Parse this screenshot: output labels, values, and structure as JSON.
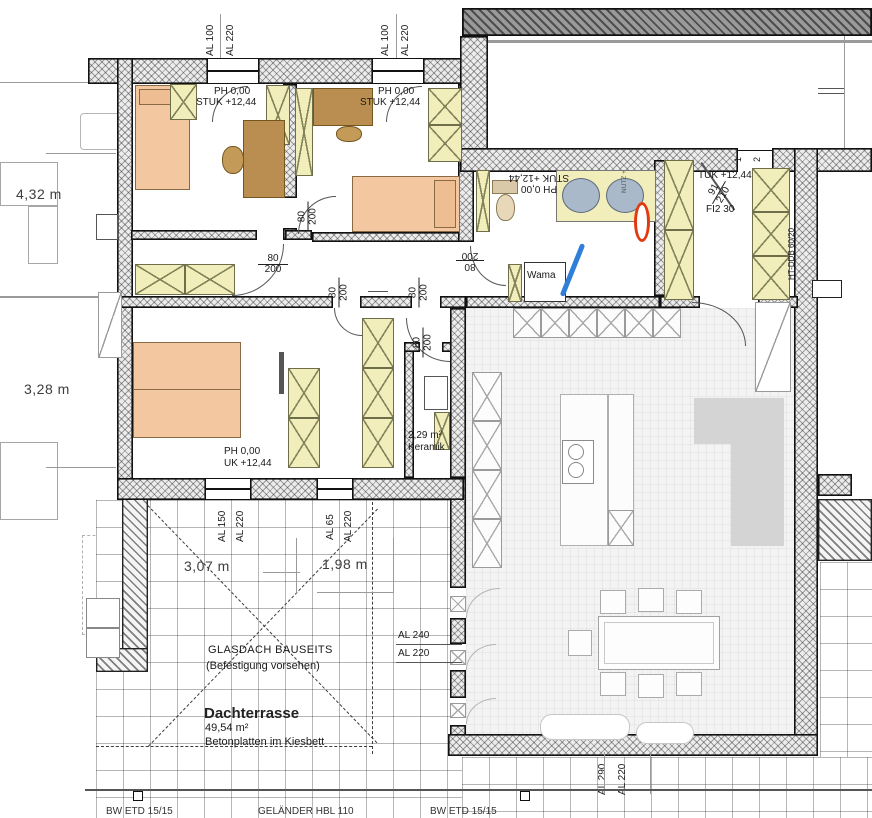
{
  "dims": {
    "left_top": "4,32 m",
    "left_bottom": "3,28 m",
    "terrace_a": "3,07 m",
    "terrace_b": "1,98 m"
  },
  "levels": {
    "b1": {
      "a": "PH 0,00",
      "b": "STUK +12,44"
    },
    "b2": {
      "a": "PH 0,00",
      "b": "STUK +12,44"
    },
    "entry": {
      "a": "PH 0,00",
      "b": "STUK +12,44"
    },
    "b3": {
      "a": "PH 0,00",
      "b": "UK +12,44"
    },
    "hall": {
      "a": "TUK +12,44"
    }
  },
  "windows": {
    "top1a": "AL 100",
    "top1b": "AL 220",
    "top2a": "AL 100",
    "top2b": "AL 220",
    "b3w1a": "AL 150",
    "b3w1b": "AL 220",
    "b3w2a": "AL 65",
    "b3w2b": "AL 220",
    "terr_a": "AL 240",
    "terr_b": "AL 220",
    "bot_a": "AL 290",
    "bot_b": "AL 220"
  },
  "doors": {
    "std_w": "80",
    "std_h": "200",
    "entry_w": "91",
    "entry_h": "210",
    "entry_note": "FI2 30",
    "tag1": "1",
    "tag2": "2"
  },
  "bath": {
    "area": "2,29 m²",
    "mat": "Keramik",
    "washer": "Wama",
    "tiny": "NUTZ +"
  },
  "terrace": {
    "glass1": "GLASDACH BAUSEITS",
    "glass2": "(Befestigung vorsehen)",
    "name": "Dachterrasse",
    "area": "49,54 m²",
    "note": "Betonplatten im Kiesbett"
  },
  "misc": {
    "duct": "HT-DDB 60/20",
    "edge1": "BW ETD 15/15",
    "edge2": "GELÄNDER HBL 110",
    "edge3": "BW ETD 15/15"
  },
  "colors": {
    "bed": "#f3c8a0",
    "desk": "#b98e50",
    "wardrobe": "#f2eebc",
    "annotation_blue": "#2f7fd8",
    "annotation_red": "#e23a10",
    "sink": "#a9b9c9",
    "wall_dark": "#9d9d9d"
  }
}
